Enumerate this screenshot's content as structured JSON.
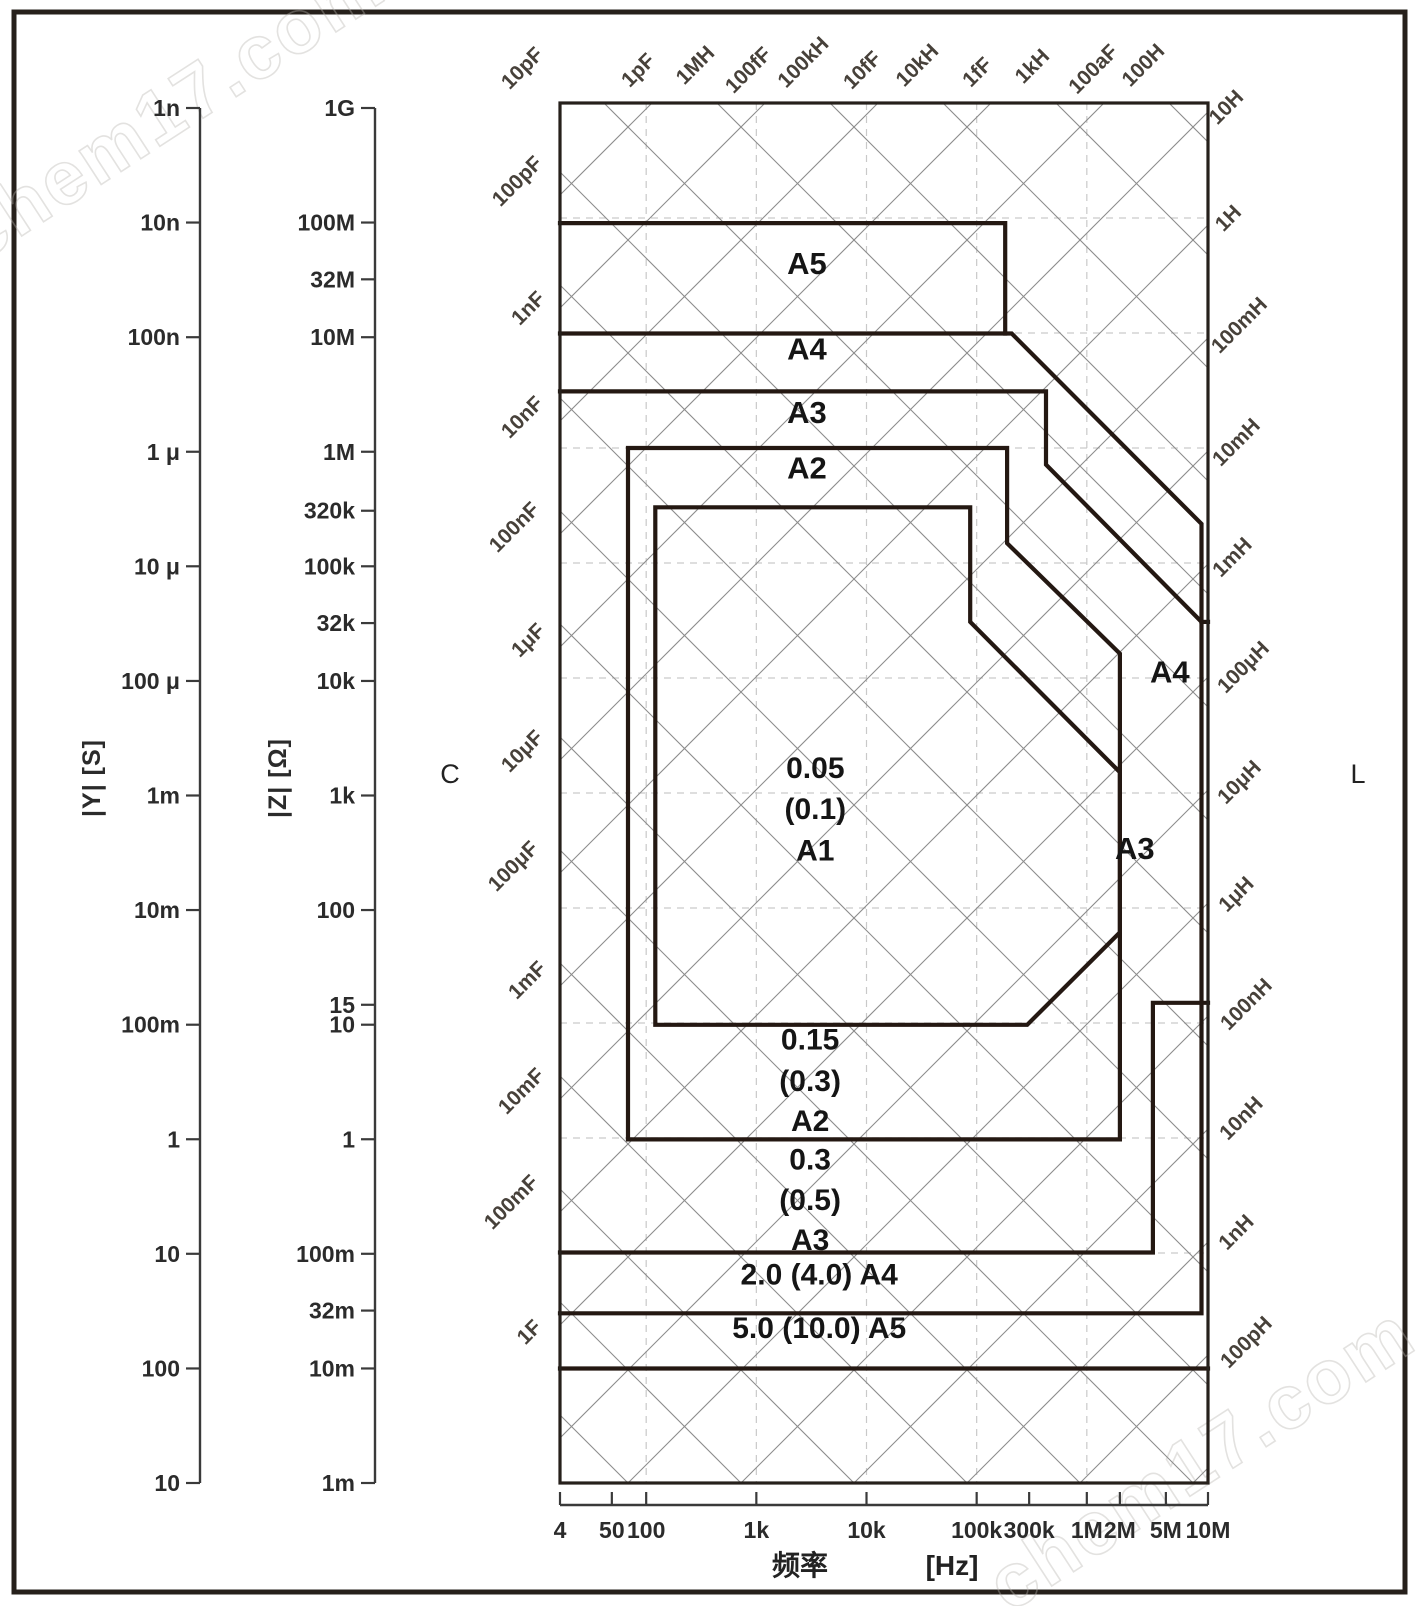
{
  "figure": {
    "watermark": "chem17.com",
    "description": "LCR meter guaranteed measurement accuracy range chart: impedance |Z| / admittance |Y| versus measurement frequency, with accuracy zones A1-A5 and capacitance / inductance diagonal guide lines"
  },
  "axes": {
    "y_admittance": {
      "title": "|Y|  [S]"
    },
    "y_impedance": {
      "title": "|Z|  [Ω]"
    },
    "x_frequency": {
      "title": "频率",
      "unit": "[Hz]"
    },
    "c_label": "C",
    "l_label": "L"
  },
  "chart_data": {
    "type": "area",
    "title": "Measurement accuracy guaranteed range (accuracy zones on log-log |Z| vs frequency plane)",
    "xlabel": "频率 [Hz]",
    "ylabel_left_1": "|Y| [S]",
    "ylabel_left_2": "|Z| [Ω]",
    "x_range": [
      "4",
      "10M"
    ],
    "z_range": [
      "1m",
      "1G"
    ],
    "grid_on": true,
    "x_ticks": [
      {
        "label": "4",
        "frac": 0
      },
      {
        "label": "50",
        "frac": 0.08
      },
      {
        "label": "100",
        "frac": 0.133
      },
      {
        "label": "1k",
        "frac": 0.303
      },
      {
        "label": "10k",
        "frac": 0.473
      },
      {
        "label": "100k",
        "frac": 0.643
      },
      {
        "label": "300k",
        "frac": 0.724
      },
      {
        "label": "1M",
        "frac": 0.813
      },
      {
        "label": "2M",
        "frac": 0.864
      },
      {
        "label": "5M",
        "frac": 0.935
      },
      {
        "label": "10M",
        "frac": 1.0
      }
    ],
    "z_ticks": [
      {
        "label": "1G",
        "frac": 0
      },
      {
        "label": "100M",
        "frac": 0.0833
      },
      {
        "label": "32M",
        "frac": 0.1246
      },
      {
        "label": "10M",
        "frac": 0.1667
      },
      {
        "label": "1M",
        "frac": 0.25
      },
      {
        "label": "320k",
        "frac": 0.2929
      },
      {
        "label": "100k",
        "frac": 0.3333
      },
      {
        "label": "32k",
        "frac": 0.3746
      },
      {
        "label": "10k",
        "frac": 0.4167
      },
      {
        "label": "1k",
        "frac": 0.5
      },
      {
        "label": "100",
        "frac": 0.5833
      },
      {
        "label": "15",
        "frac": 0.6522
      },
      {
        "label": "10",
        "frac": 0.6667
      },
      {
        "label": "1",
        "frac": 0.75
      },
      {
        "label": "100m",
        "frac": 0.8333
      },
      {
        "label": "32m",
        "frac": 0.8746
      },
      {
        "label": "10m",
        "frac": 0.9167
      },
      {
        "label": "1m",
        "frac": 1.0
      }
    ],
    "y_ticks": [
      {
        "label": "1n",
        "frac": 0
      },
      {
        "label": "10n",
        "frac": 0.0833
      },
      {
        "label": "100n",
        "frac": 0.1667
      },
      {
        "label": "1 μ",
        "frac": 0.25
      },
      {
        "label": "10 μ",
        "frac": 0.3333
      },
      {
        "label": "100 μ",
        "frac": 0.4167
      },
      {
        "label": "1m",
        "frac": 0.5
      },
      {
        "label": "10m",
        "frac": 0.5833
      },
      {
        "label": "100m",
        "frac": 0.6667
      },
      {
        "label": "1",
        "frac": 0.75
      },
      {
        "label": "10",
        "frac": 0.8333
      },
      {
        "label": "100",
        "frac": 0.9167
      },
      {
        "label": "10",
        "frac": 1.0
      }
    ],
    "zones": [
      {
        "name": "A1",
        "accuracy": "0.05",
        "accuracy_paren": "(0.1)"
      },
      {
        "name": "A2",
        "accuracy": "0.15",
        "accuracy_paren": "(0.3)"
      },
      {
        "name": "A3",
        "accuracy": "0.3",
        "accuracy_paren": "(0.5)"
      },
      {
        "name": "A4",
        "accuracy": "2.0",
        "accuracy_paren": "(4.0)"
      },
      {
        "name": "A5",
        "accuracy": "5.0",
        "accuracy_paren": "(10.0)"
      }
    ],
    "zone_outlines": {
      "open": [
        [
          [
            0,
            0.087
          ],
          [
            0.687,
            0.087
          ],
          [
            0.687,
            0.167
          ]
        ],
        [
          [
            0,
            0.167
          ],
          [
            0.697,
            0.167
          ],
          [
            0.99,
            0.305
          ],
          [
            0.99,
            0.877
          ],
          [
            0,
            0.877
          ]
        ],
        [
          [
            0.99,
            0.376
          ],
          [
            1,
            0.376
          ]
        ],
        [
          [
            0,
            0.209
          ],
          [
            0.75,
            0.209
          ],
          [
            0.75,
            0.262
          ],
          [
            0.99,
            0.376
          ]
        ],
        [
          [
            1,
            0.652
          ],
          [
            0.915,
            0.652
          ],
          [
            0.915,
            0.833
          ],
          [
            0,
            0.833
          ]
        ],
        [
          [
            0,
            0.917
          ],
          [
            1,
            0.917
          ]
        ]
      ],
      "closed": [
        [
          [
            0.105,
            0.25
          ],
          [
            0.69,
            0.25
          ],
          [
            0.69,
            0.319
          ],
          [
            0.864,
            0.399
          ],
          [
            0.864,
            0.751
          ],
          [
            0.105,
            0.751
          ]
        ],
        [
          [
            0.147,
            0.293
          ],
          [
            0.633,
            0.293
          ],
          [
            0.633,
            0.376
          ],
          [
            0.864,
            0.485
          ],
          [
            0.864,
            0.601
          ],
          [
            0.721,
            0.668
          ],
          [
            0.147,
            0.668
          ]
        ]
      ]
    },
    "zone_labels": [
      {
        "t": "A5",
        "x": 0.381,
        "y": 0.124,
        "fs": 31
      },
      {
        "t": "A4",
        "x": 0.381,
        "y": 0.186,
        "fs": 31
      },
      {
        "t": "A3",
        "x": 0.381,
        "y": 0.232,
        "fs": 31
      },
      {
        "t": "A2",
        "x": 0.381,
        "y": 0.272,
        "fs": 31
      },
      {
        "t": "0.05",
        "x": 0.394,
        "y": 0.489,
        "fs": 30
      },
      {
        "t": "(0.1)",
        "x": 0.394,
        "y": 0.519,
        "fs": 30
      },
      {
        "t": "A1",
        "x": 0.394,
        "y": 0.549,
        "fs": 30
      },
      {
        "t": "A4",
        "x": 0.941,
        "y": 0.42,
        "fs": 31
      },
      {
        "t": "A3",
        "x": 0.887,
        "y": 0.548,
        "fs": 31
      },
      {
        "t": "0.15",
        "x": 0.386,
        "y": 0.686,
        "fs": 30
      },
      {
        "t": "(0.3)",
        "x": 0.386,
        "y": 0.716,
        "fs": 30
      },
      {
        "t": "A2",
        "x": 0.386,
        "y": 0.745,
        "fs": 30
      },
      {
        "t": "0.3",
        "x": 0.386,
        "y": 0.773,
        "fs": 30
      },
      {
        "t": "(0.5)",
        "x": 0.386,
        "y": 0.802,
        "fs": 30
      },
      {
        "t": "A3",
        "x": 0.386,
        "y": 0.831,
        "fs": 30
      },
      {
        "t": "2.0  (4.0)    A4",
        "x": 0.4,
        "y": 0.856,
        "fs": 30
      },
      {
        "t": "5.0  (10.0)    A5",
        "x": 0.4,
        "y": 0.895,
        "fs": 30
      }
    ],
    "diagonal_labels": {
      "rotation": -45,
      "top": [
        {
          "label": "10pF",
          "x": 527,
          "y": 73
        },
        {
          "label": "1pF",
          "x": 643,
          "y": 75
        },
        {
          "label": "1MH",
          "x": 700,
          "y": 70
        },
        {
          "label": "100fF",
          "x": 753,
          "y": 75
        },
        {
          "label": "100kH",
          "x": 808,
          "y": 67
        },
        {
          "label": "10fF",
          "x": 867,
          "y": 75
        },
        {
          "label": "10kH",
          "x": 922,
          "y": 70
        },
        {
          "label": "1fF",
          "x": 982,
          "y": 77
        },
        {
          "label": "1kH",
          "x": 1037,
          "y": 71
        },
        {
          "label": "100aF",
          "x": 1098,
          "y": 74
        },
        {
          "label": "100H",
          "x": 1148,
          "y": 70
        }
      ],
      "left": [
        {
          "label": "100pF",
          "x": 522,
          "y": 186
        },
        {
          "label": "1nF",
          "x": 533,
          "y": 313
        },
        {
          "label": "10nF",
          "x": 527,
          "y": 422
        },
        {
          "label": "100nF",
          "x": 519,
          "y": 532
        },
        {
          "label": "1μF",
          "x": 533,
          "y": 645
        },
        {
          "label": "10μF",
          "x": 527,
          "y": 756
        },
        {
          "label": "100μF",
          "x": 518,
          "y": 871
        },
        {
          "label": "1mF",
          "x": 532,
          "y": 985
        },
        {
          "label": "10mF",
          "x": 526,
          "y": 1096
        },
        {
          "label": "100mF",
          "x": 516,
          "y": 1207
        },
        {
          "label": "1F",
          "x": 534,
          "y": 1337
        }
      ],
      "right": [
        {
          "label": "10H",
          "x": 1231,
          "y": 112
        },
        {
          "label": "1H",
          "x": 1233,
          "y": 223
        },
        {
          "label": "100mH",
          "x": 1244,
          "y": 330
        },
        {
          "label": "10mH",
          "x": 1241,
          "y": 447
        },
        {
          "label": "1mH",
          "x": 1237,
          "y": 562
        },
        {
          "label": "100μH",
          "x": 1248,
          "y": 672
        },
        {
          "label": "10μH",
          "x": 1244,
          "y": 787
        },
        {
          "label": "1μH",
          "x": 1241,
          "y": 899
        },
        {
          "label": "100nH",
          "x": 1251,
          "y": 1009
        },
        {
          "label": "10nH",
          "x": 1246,
          "y": 1123
        },
        {
          "label": "1nH",
          "x": 1241,
          "y": 1237
        },
        {
          "label": "100pH",
          "x": 1251,
          "y": 1347
        }
      ]
    },
    "grid": {
      "diag_spacing_px": 113,
      "backslash_c0": -69,
      "backslash_k": [
        -11,
        6
      ],
      "slash_b0": 657,
      "slash_k": [
        -5,
        12
      ],
      "dashed_v_fracs": [
        0.133,
        0.303,
        0.473,
        0.643,
        0.813
      ]
    }
  }
}
